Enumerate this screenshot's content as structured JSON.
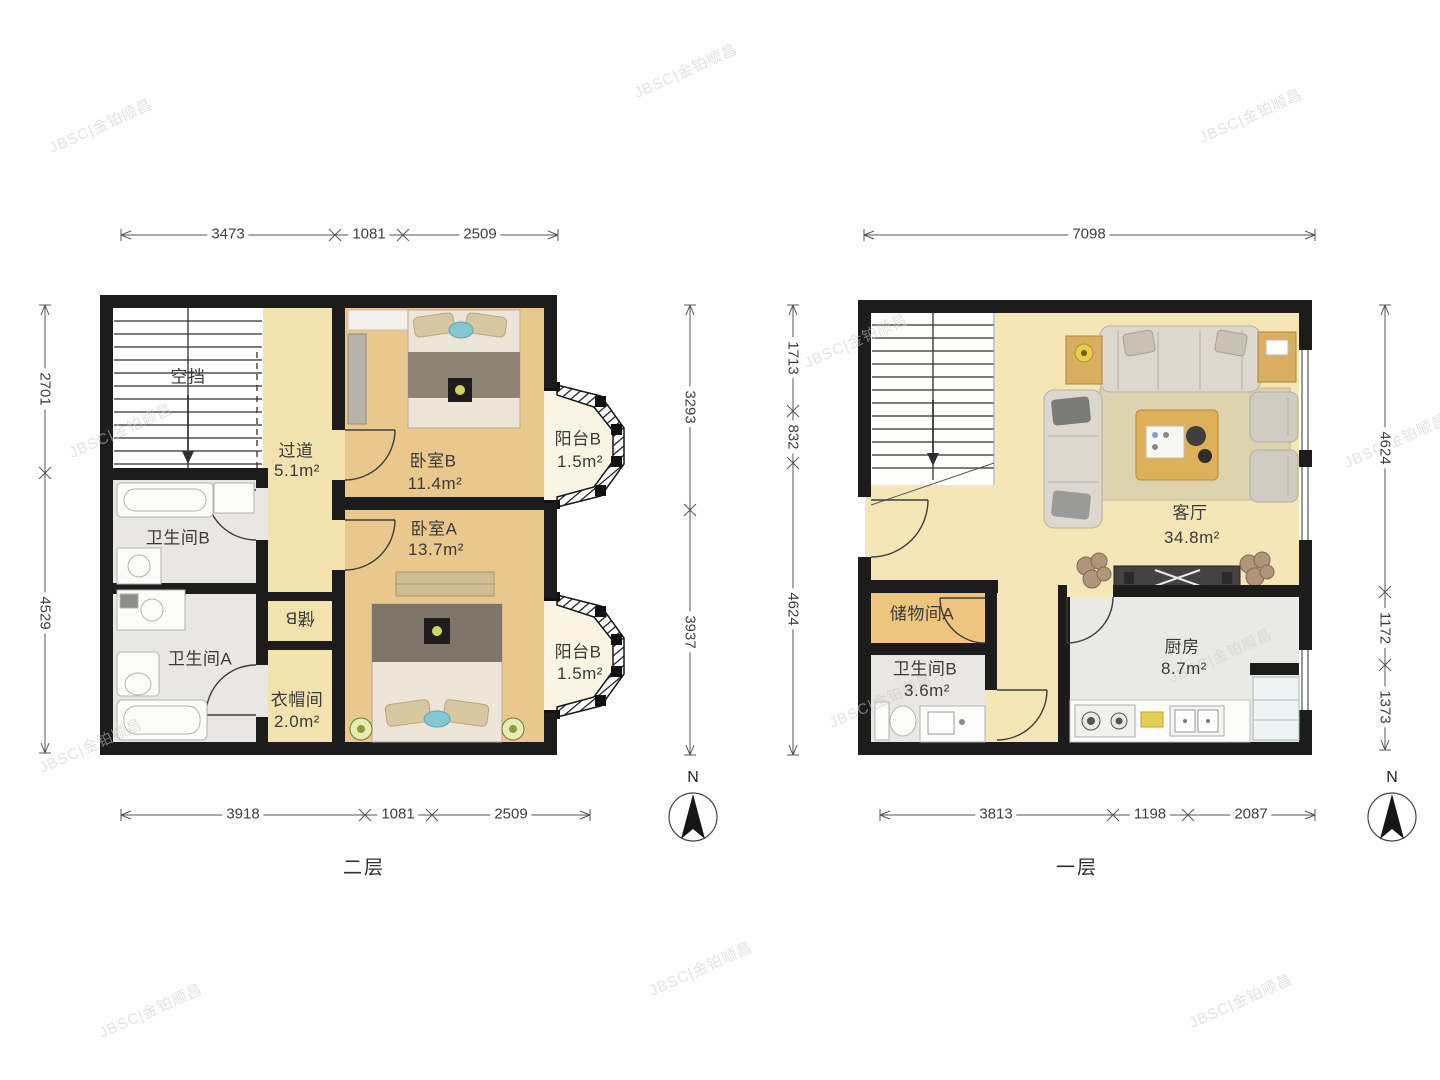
{
  "watermark": {
    "text": "JBSC|金铂顺昌"
  },
  "compass": {
    "north_label": "N"
  },
  "floor2": {
    "title": "二层",
    "dims": {
      "top": [
        "3473",
        "1081",
        "2509"
      ],
      "bottom": [
        "3918",
        "1081",
        "2509"
      ],
      "left": [
        "2701",
        "4529"
      ],
      "right": [
        "3293",
        "3937"
      ]
    },
    "rooms": {
      "void": {
        "name": "空挡"
      },
      "corridor": {
        "name": "过道",
        "area": "5.1m²"
      },
      "bedroom_b": {
        "name": "卧室B",
        "area": "11.4m²"
      },
      "balcony_top": {
        "name": "阳台B",
        "area": "1.5m²"
      },
      "bedroom_a": {
        "name": "卧室A",
        "area": "13.7m²"
      },
      "balcony_bottom": {
        "name": "阳台B",
        "area": "1.5m²"
      },
      "bathroom_b": {
        "name": "卫生间B"
      },
      "bathroom_a": {
        "name": "卫生间A"
      },
      "cloakroom": {
        "name": "衣帽间",
        "area": "2.0m²"
      },
      "closet_b": {
        "name": "储B"
      }
    }
  },
  "floor1": {
    "title": "一层",
    "dims": {
      "top": [
        "7098"
      ],
      "bottom": [
        "3813",
        "1198",
        "2087"
      ],
      "left": [
        "1713",
        "832",
        "4624"
      ],
      "right": [
        "4624",
        "1172",
        "1373"
      ]
    },
    "rooms": {
      "living": {
        "name": "客厅",
        "area": "34.8m²"
      },
      "storage_a": {
        "name": "储物间A"
      },
      "bathroom_b": {
        "name": "卫生间B",
        "area": "3.6m²"
      },
      "kitchen": {
        "name": "厨房",
        "area": "8.7m²"
      }
    }
  }
}
